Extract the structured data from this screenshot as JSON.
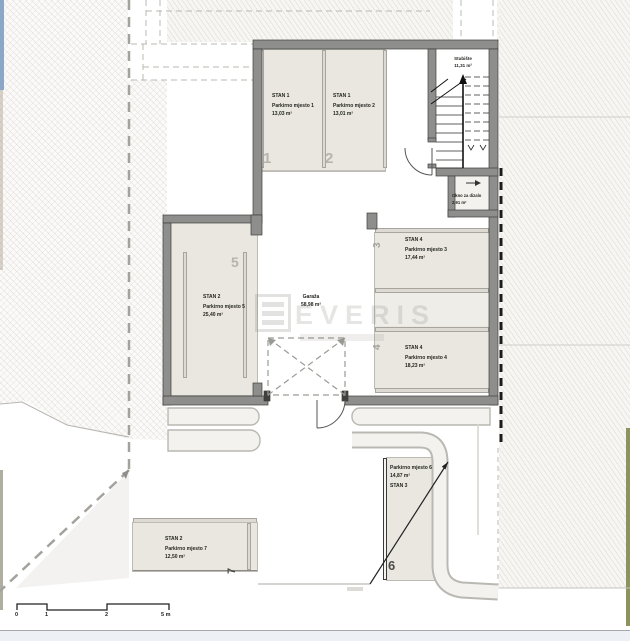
{
  "watermark": {
    "brand": "EVERIS"
  },
  "rooms": {
    "garage": {
      "name": "Garaža",
      "area": "58,98 m²"
    },
    "staircase": {
      "name": "Stubište",
      "area": "11,31 m²"
    },
    "elevator_shaft": {
      "name": "Okno za dizalo",
      "area": "2,91 m²"
    }
  },
  "parking_spots": [
    {
      "number": "1",
      "unit": "STAN 1",
      "name": "Parkirno mjesto 1",
      "area": "13,03 m²"
    },
    {
      "number": "2",
      "unit": "STAN 1",
      "name": "Parkirno mjesto 2",
      "area": "13,01 m²"
    },
    {
      "number": "3",
      "unit": "STAN 4",
      "name": "Parkirno mjesto 3",
      "area": "17,44 m²"
    },
    {
      "number": "4",
      "unit": "STAN 4",
      "name": "Parkirno mjesto 4",
      "area": "18,23 m²"
    },
    {
      "number": "5",
      "unit": "STAN 2",
      "name": "Parkirno mjesto 5",
      "area": "25,40 m²"
    },
    {
      "number": "6",
      "unit": "STAN 3",
      "name": "Parkirno mjesto 6",
      "area": "14,87 m²"
    },
    {
      "number": "7",
      "unit": "STAN 2",
      "name": "Parkirno mjesto 7",
      "area": "12,50 m²"
    }
  ],
  "scale_bar": {
    "labels": [
      "0",
      "1",
      "2",
      "5 m"
    ]
  },
  "colors": {
    "wall": "#8e8e8c",
    "parking_fill": "#e9e7e0",
    "hatch_line": "#b9b7b0",
    "edge_blue": "#8ba6c6",
    "edge_green": "#8f925f"
  }
}
